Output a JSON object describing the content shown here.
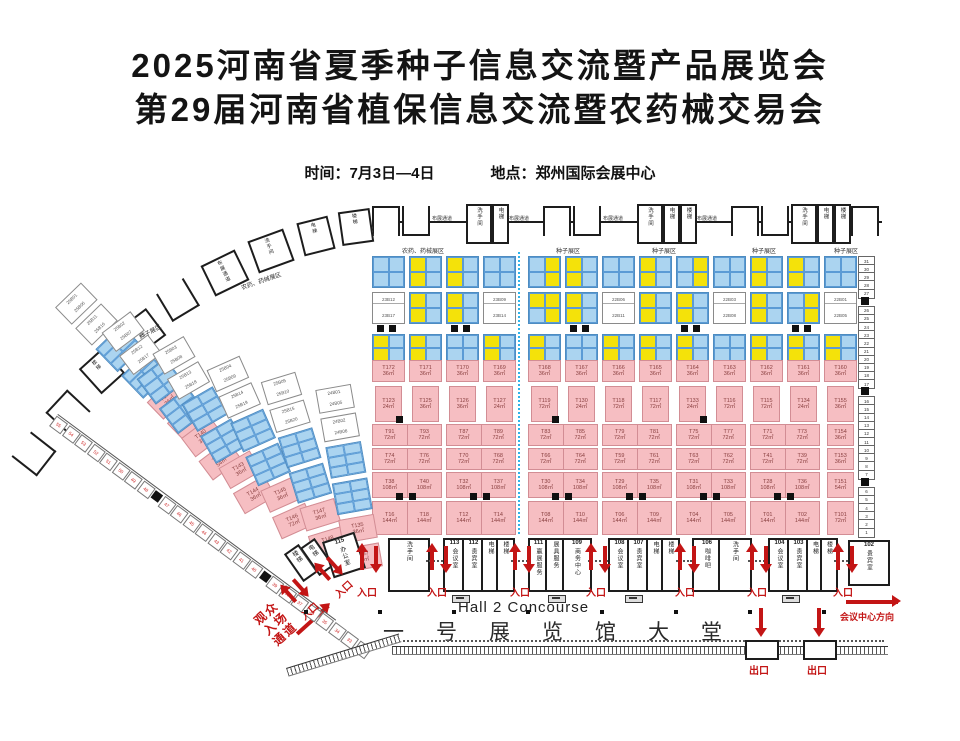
{
  "header": {
    "title_line1": "2025河南省夏季种子信息交流暨产品展览会",
    "title_line2": "第29届河南省植保信息交流暨农药械交易会",
    "time_label": "时间：",
    "time_value": "7月3日—4日",
    "place_label": "地点：",
    "place_value": "郑州国际会展中心"
  },
  "plan": {
    "hall_en": "Hall 2 Concourse",
    "hall_cn": "一号展览馆大堂",
    "entrance_label": "入口",
    "exit_label": "出口",
    "direction_label": "会议中心方向",
    "visitor_path": [
      "观众",
      "入场",
      "通道"
    ],
    "section_labels": {
      "top_row": [
        "农药、药械展区",
        "种子展区",
        "种子展区",
        "种子展区",
        "种子展区"
      ],
      "left_rot_pesticide": "农药、药械展区",
      "left_rot_seed": "种子展区"
    },
    "top_wall_sequence": [
      {
        "t": "br"
      },
      {
        "t": "br"
      },
      {
        "t": "lb",
        "x": "布展通道"
      },
      {
        "t": "rm",
        "x": "洗手间"
      },
      {
        "t": "rm",
        "x": "电梯"
      },
      {
        "t": "lb",
        "x": "布展通道"
      },
      {
        "t": "br"
      },
      {
        "t": "br"
      },
      {
        "t": "lb",
        "x": "布展通道"
      },
      {
        "t": "rm",
        "x": "洗手间"
      },
      {
        "t": "rm",
        "x": "电梯"
      },
      {
        "t": "rm",
        "x": "楼梯"
      },
      {
        "t": "lb",
        "x": "布展通道"
      },
      {
        "t": "br"
      },
      {
        "t": "br"
      },
      {
        "t": "rm",
        "x": "洗手间"
      },
      {
        "t": "rm",
        "x": "电梯"
      },
      {
        "t": "rm",
        "x": "楼梯"
      },
      {
        "t": "br"
      }
    ],
    "arc_room_labels": [
      "",
      "",
      "楼梯",
      "洗手间",
      "",
      "布展通道",
      "洗手间",
      "电梯",
      "楼梯"
    ],
    "facilities": [
      {
        "num": "",
        "label": "楼梯"
      },
      {
        "num": "",
        "label": "电梯"
      },
      {
        "num": "115",
        "label": "办公室"
      },
      {
        "num": "",
        "label": "洗手间"
      },
      {
        "num": "113",
        "label": "会议室"
      },
      {
        "num": "112",
        "label": "贵宾室"
      },
      {
        "num": "",
        "label": "电梯"
      },
      {
        "num": "",
        "label": "楼梯"
      },
      {
        "num": "111",
        "label": "赢展服务"
      },
      {
        "num": "",
        "label": "展具服务"
      },
      {
        "num": "109",
        "label": "商务中心"
      },
      {
        "num": "108",
        "label": "会议室"
      },
      {
        "num": "107",
        "label": "贵宾室"
      },
      {
        "num": "",
        "label": "电梯"
      },
      {
        "num": "",
        "label": "楼梯"
      },
      {
        "num": "106",
        "label": "咖啡吧"
      },
      {
        "num": "",
        "label": "洗手间"
      },
      {
        "num": "104",
        "label": "会议室"
      },
      {
        "num": "103",
        "label": "贵宾室"
      },
      {
        "num": "",
        "label": "电梯"
      },
      {
        "num": "",
        "label": "楼梯"
      },
      {
        "num": "102",
        "label": "贵宾室"
      }
    ],
    "right_grid": {
      "rowA": [
        "bbbb",
        "ybyb",
        "ybyb",
        "bbbb",
        "byby",
        "ybyb",
        "bbbb",
        "ybyb",
        "byby",
        "bbbb",
        "ybyb",
        "ybyb",
        "bbbb"
      ],
      "rowB": [
        {
          "t": [
            "23B12",
            "23B17"
          ]
        },
        {
          "p": "ybyb"
        },
        {
          "p": "ybyb"
        },
        {
          "t": [
            "23B09",
            "23B14"
          ]
        },
        {
          "p": "yyby"
        },
        {
          "p": "ybyb"
        },
        {
          "t": [
            "22B06",
            "22B11"
          ]
        },
        {
          "p": "ybyb"
        },
        {
          "p": "ybyb"
        },
        {
          "t": [
            "22B03",
            "22B08"
          ]
        },
        {
          "p": "ybyb"
        },
        {
          "p": "byby"
        },
        {
          "t": [
            "22B01",
            "22B05"
          ]
        }
      ],
      "rowC": [
        "ybyb",
        "ybyb",
        "bbbb",
        "ybyb",
        "ybyb",
        "bbbb",
        "ybyb",
        "ybyb",
        "ybyb",
        "bbbb",
        "ybyb",
        "ybyb",
        "ybyb"
      ],
      "labels": [
        [
          "T172",
          "36㎡"
        ],
        [
          "T171",
          "36㎡"
        ],
        [
          "T170",
          "36㎡"
        ],
        [
          "T169",
          "36㎡"
        ],
        [
          "T168",
          "36㎡"
        ],
        [
          "T167",
          "36㎡"
        ],
        [
          "T166",
          "36㎡"
        ],
        [
          "T165",
          "36㎡"
        ],
        [
          "T164",
          "36㎡"
        ],
        [
          "T163",
          "36㎡"
        ],
        [
          "T162",
          "36㎡"
        ],
        [
          "T161",
          "36㎡"
        ],
        [
          "T160",
          "36㎡"
        ]
      ],
      "smalls": [
        [
          "T123",
          "24㎡"
        ],
        [
          "T125",
          "36㎡"
        ],
        [
          "T126",
          "36㎡"
        ],
        [
          "T127",
          "24㎡"
        ],
        [
          "T119",
          "72㎡"
        ],
        [
          "T130",
          "24㎡"
        ],
        [
          "T118",
          "72㎡"
        ],
        [
          "T117",
          "72㎡"
        ],
        [
          "T133",
          "24㎡"
        ],
        [
          "T116",
          "72㎡"
        ],
        [
          "T115",
          "72㎡"
        ],
        [
          "T134",
          "24㎡"
        ]
      ],
      "pairs": [
        [
          [
            "T91",
            "72㎡",
            "T93",
            "72㎡"
          ],
          [
            "T74",
            "72㎡",
            "T76",
            "72㎡"
          ],
          [
            "T38",
            "108㎡",
            "T40",
            "108㎡"
          ],
          [
            "T16",
            "144㎡",
            "T18",
            "144㎡"
          ]
        ],
        [
          [
            "T87",
            "72㎡",
            "T89",
            "72㎡"
          ],
          [
            "T70",
            "72㎡",
            "T68",
            "72㎡"
          ],
          [
            "T32",
            "108㎡",
            "T37",
            "108㎡"
          ],
          [
            "T12",
            "144㎡",
            "T14",
            "144㎡"
          ]
        ],
        [
          [
            "T83",
            "72㎡",
            "T85",
            "72㎡"
          ],
          [
            "T66",
            "72㎡",
            "T64",
            "72㎡"
          ],
          [
            "T30",
            "108㎡",
            "T34",
            "108㎡"
          ],
          [
            "T08",
            "144㎡",
            "T10",
            "144㎡"
          ]
        ],
        [
          [
            "T79",
            "72㎡",
            "T81",
            "72㎡"
          ],
          [
            "T59",
            "72㎡",
            "T61",
            "72㎡"
          ],
          [
            "T29",
            "108㎡",
            "T35",
            "108㎡"
          ],
          [
            "T06",
            "144㎡",
            "T09",
            "144㎡"
          ]
        ],
        [
          [
            "T75",
            "72㎡",
            "T77",
            "72㎡"
          ],
          [
            "T63",
            "72㎡",
            "T62",
            "72㎡"
          ],
          [
            "T31",
            "108㎡",
            "T33",
            "108㎡"
          ],
          [
            "T04",
            "144㎡",
            "T05",
            "144㎡"
          ]
        ],
        [
          [
            "T71",
            "72㎡",
            "T73",
            "72㎡"
          ],
          [
            "T41",
            "72㎡",
            "T39",
            "72㎡"
          ],
          [
            "T28",
            "108㎡",
            "T36",
            "108㎡"
          ],
          [
            "T01",
            "144㎡",
            "T02",
            "144㎡"
          ]
        ]
      ],
      "singles": [
        [
          "T155",
          "36㎡"
        ],
        [
          "T154",
          "36㎡"
        ],
        [
          "T153",
          "36㎡"
        ],
        [
          "T151",
          "54㎡"
        ],
        [
          "T101",
          "72㎡"
        ]
      ],
      "pillar_cols": [
        0,
        2,
        5,
        8,
        11
      ]
    },
    "side_strip": {
      "numbers": [
        "31",
        "30",
        "29",
        "28",
        "27",
        "26",
        "25",
        "24",
        "23",
        "22",
        "21",
        "20",
        "19",
        "18",
        "17",
        "16",
        "15",
        "14",
        "13",
        "12",
        "11",
        "10",
        "9",
        "8",
        "7",
        "6",
        "5",
        "4",
        "3",
        "2",
        "1"
      ],
      "pillar_after": [
        4,
        14,
        24
      ]
    },
    "left_strip": {
      "numbers": [
        "55",
        "54",
        "53",
        "52",
        "51",
        "50",
        "49",
        "48",
        "47",
        "46",
        "45",
        "44",
        "43",
        "42",
        "41",
        "40",
        "39",
        "38",
        "37",
        "36",
        "35",
        "34",
        "33",
        "32"
      ],
      "pillar_after": [
        7,
        15
      ]
    },
    "fan_columns": [
      {
        "white": [
          [
            "25B01",
            "25B06"
          ],
          [
            "25B11",
            "25B16"
          ]
        ],
        "pinks": [
          [
            "T139",
            "36㎡"
          ],
          [
            "T141",
            "54㎡"
          ]
        ]
      },
      {
        "white": [
          [
            "25B02",
            "25B07"
          ],
          [
            "25B12",
            "25B17"
          ]
        ],
        "pinks": [
          [
            "T140",
            "36㎡"
          ],
          [
            "T142",
            "54㎡"
          ]
        ]
      },
      {
        "white": [
          [
            "25B03",
            "25B08"
          ],
          [
            "25B13",
            "25B18"
          ]
        ],
        "pinks": [
          [
            "T143",
            "36㎡"
          ],
          [
            "T144",
            "36㎡"
          ]
        ]
      },
      {
        "white": [
          [
            "25B04",
            "25B09"
          ],
          [
            "25B14",
            "25B19"
          ]
        ],
        "pinks": [
          [
            "T145",
            "36㎡"
          ],
          [
            "T146",
            "72㎡"
          ]
        ]
      },
      {
        "white": [
          [
            "25B05",
            "25B10"
          ],
          [
            "25B15",
            "25B20"
          ]
        ],
        "pinks": [
          [
            "T147",
            "36㎡"
          ],
          [
            "T148",
            "72㎡"
          ]
        ]
      },
      {
        "white": [
          [
            "24B01",
            "24B05"
          ],
          [
            "24B02",
            "24B06"
          ]
        ],
        "pinks": [
          [
            "T135",
            "36㎡"
          ],
          [
            "T137",
            "72㎡"
          ]
        ]
      }
    ]
  },
  "colors": {
    "booth_blue": "#abd4f0",
    "booth_yellow": "#f4e20a",
    "booth_pink": "#f6bec2",
    "accent_red": "#c31515",
    "divider_cyan": "#2fb3ea",
    "wall_black": "#1d1d1d"
  }
}
